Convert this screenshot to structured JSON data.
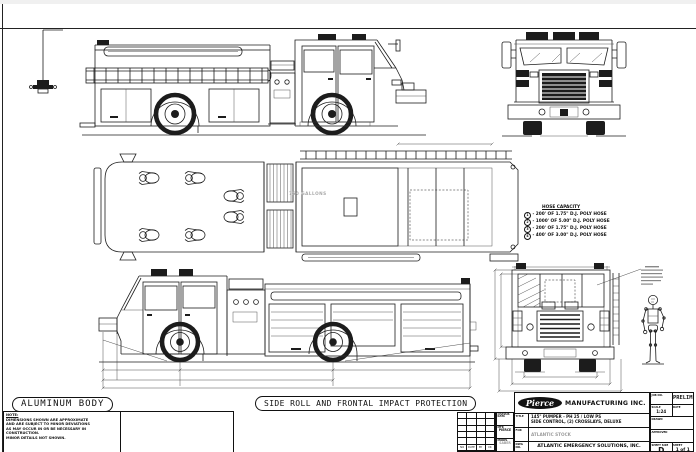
{
  "sheet": {
    "bg": "#ffffff",
    "line_color": "#1c1c1c",
    "gray_text": "#a9a9a9"
  },
  "callouts": {
    "aluminum_body": "ALUMINUM BODY",
    "side_roll": "SIDE ROLL AND FRONTAL IMPACT PROTECTION"
  },
  "note": {
    "title": "NOTE:",
    "lines": [
      "DIMENSIONS SHOWN ARE APPROXIMATE",
      "AND ARE SUBJECT TO MINOR DEVIATIONS",
      "AS MAY OCCUR IN OR BE NECESSARY IN",
      "CONSTRUCTION.",
      "MINOR DETAILS NOT SHOWN."
    ]
  },
  "top_view": {
    "tank_label": "750 GALLONS"
  },
  "hose_legend": {
    "title": "HOSE CAPACITY",
    "items": [
      {
        "num": "1",
        "text": "- 200' OF 1.75\" D.J. POLY HOSE"
      },
      {
        "num": "2",
        "text": "- 1000' OF 5.00\" D.J. POLY HOSE"
      },
      {
        "num": "3",
        "text": "- 200' OF 1.75\" D.J. POLY HOSE"
      },
      {
        "num": "4",
        "text": "- 400' OF 3.00\" D.J. POLY HOSE"
      }
    ]
  },
  "title_block": {
    "logo_text": "Pierce",
    "manufacturer": "MANUFACTURING INC.",
    "job_label": "JOB NO.",
    "job_value": "PRELIM",
    "scale_label": "SCALE",
    "scale_value": "1:24",
    "date_label": "DATE",
    "drawn_label": "DRAWN",
    "approved_label": "APPROVED",
    "sheet_size_label": "SHEET SIZE",
    "sheet_size_value": "D",
    "sheet_label": "SHEET",
    "sheet_value": "1 of 1",
    "chassis_header": "CHASSIS DATA",
    "mfr_label": "MFR",
    "mfr_value": "PIERCE",
    "model_label": "MODEL",
    "model_value": "SABER",
    "title_label": "TITLE",
    "title_line1": "145\" PUMPER - PH 25 / LOW PS",
    "title_line2": "SIDE CONTROL, (2) CROSSLAYS, DELUXE",
    "for_label": "FOR",
    "for_value": "ATLANTIC STOCK",
    "dwg_label": "DWG NO.",
    "dwg_value": "ATLANTIC EMERGENCY SOLUTIONS, INC.",
    "rev_headers": [
      "NO",
      "DATE",
      "BY",
      "CK"
    ]
  }
}
